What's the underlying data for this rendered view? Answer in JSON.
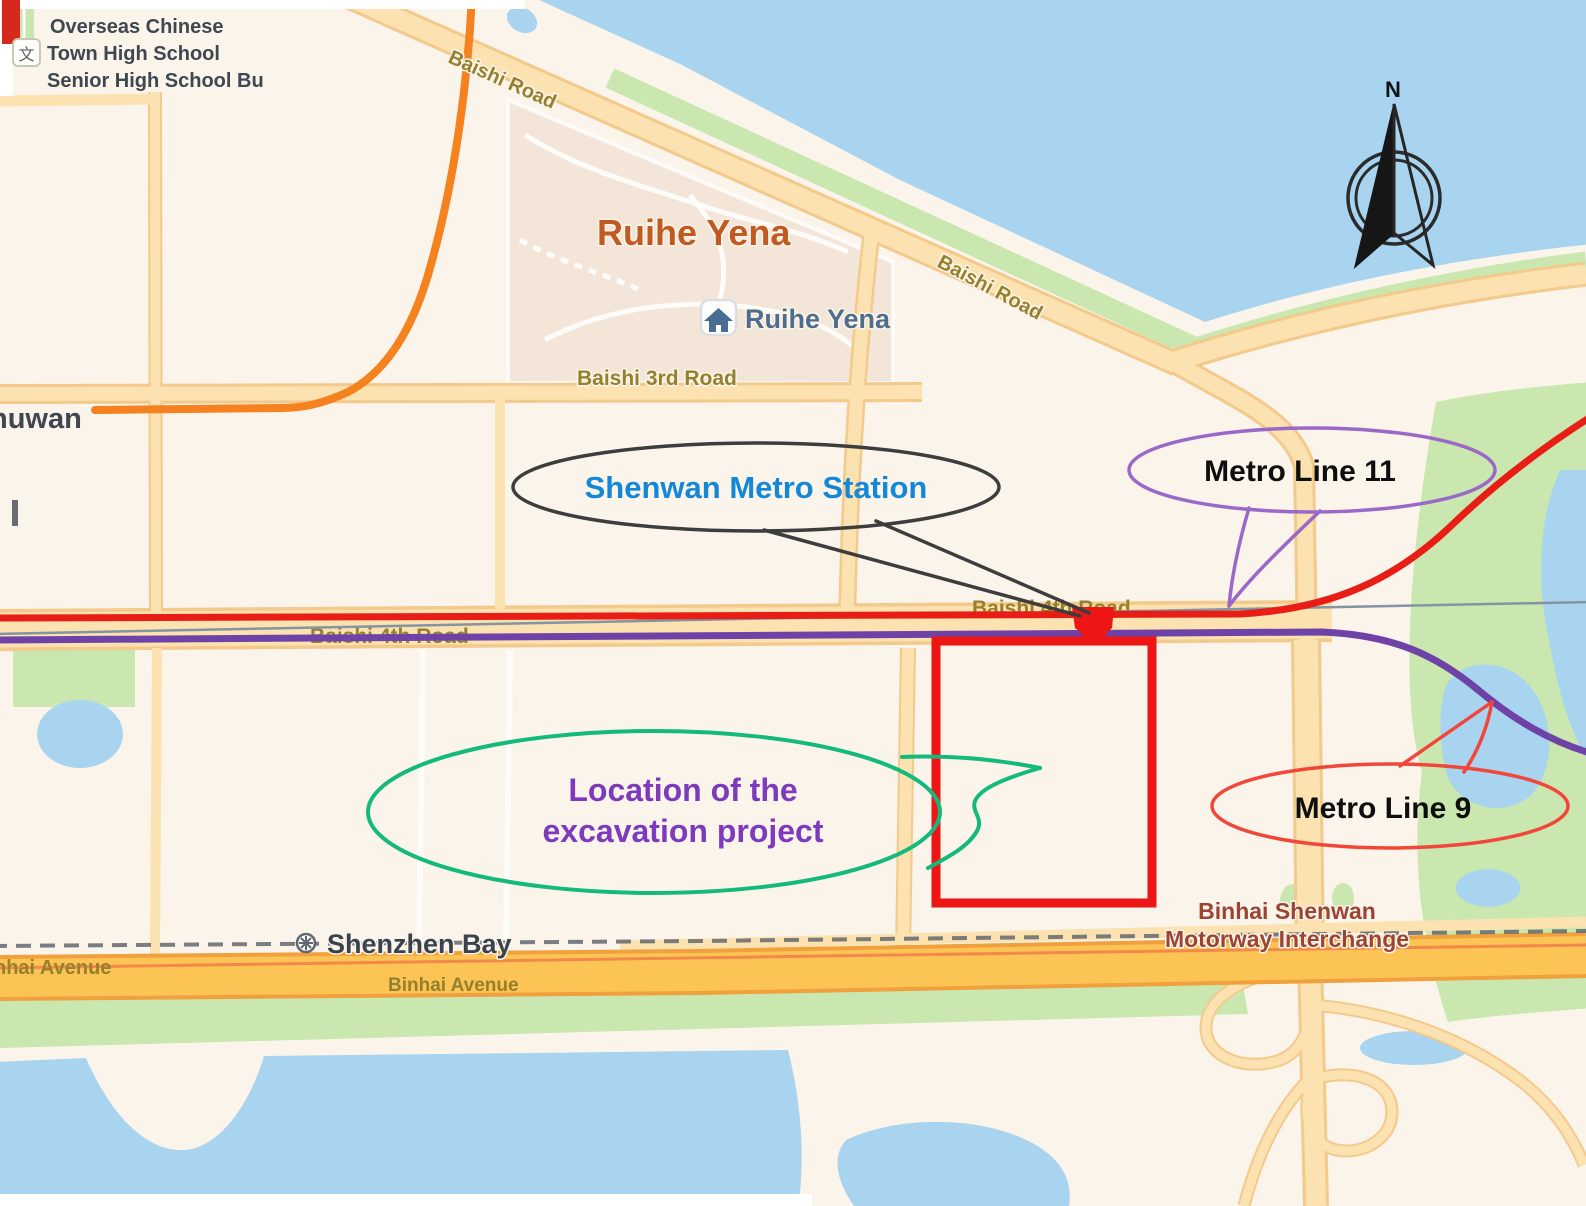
{
  "map": {
    "region_labels": {
      "school_line1": "Overseas Chinese",
      "school_line2": "Town High School",
      "school_line3": "Senior High School Bu",
      "district_partial": "nuwan",
      "residential_area": "Ruihe Yena",
      "residential_poi": "Ruihe Yena",
      "bay": "Shenzhen Bay",
      "interchange_line1": "Binhai Shenwan",
      "interchange_line2": "Motorway Interchange"
    },
    "road_labels": {
      "baishi_road": "Baishi Road",
      "baishi_3rd_road": "Baishi 3rd Road",
      "baishi_4th_road": "Baishi 4th Road",
      "binhai_avenue": "Binhai Avenue"
    },
    "callouts": {
      "station": "Shenwan Metro Station",
      "metro_line_11": "Metro Line 11",
      "metro_line_9": "Metro Line 9",
      "excavation_line1": "Location of the",
      "excavation_line2": "excavation project"
    },
    "poi_icons": {
      "school_glyph": "文"
    },
    "compass": {
      "north": "N"
    },
    "colors": {
      "water": "#a9d4ef",
      "park": "#c9e7ae",
      "land": "#fbf4ea",
      "road_fill": "#fbe2b0",
      "road_casing": "#f3c98c",
      "residential": "#f3e6d8",
      "motorway_yellow": "#fcc455",
      "motorway_casing": "#f0a03c",
      "motorway_stripe": "#f2824a",
      "major_orange_road": "#f5821f",
      "railway_gray": "#8494a2",
      "boundary_dash_gray": "#64686d",
      "metro_line_red": "#e81d15",
      "metro_line_purple": "#6f42a8",
      "excavation_box_red": "#ee1515",
      "station_callout_stroke": "#3d3d3d",
      "station_text": "#1487d8",
      "line11_callout_stroke": "#9a68c8",
      "line9_callout_stroke": "#f2463a",
      "excavation_callout_stroke": "#14b97c",
      "excavation_text": "#7d3abd",
      "callout_text_black": "#0e0e0e",
      "map_label_olive": "#95812c",
      "map_label_dark": "#3f4750",
      "bay_label_dark": "#3a434d",
      "interchange_label": "#9c4434",
      "poi_label_blue": "#4f6d8c",
      "residential_label_orange": "#c05a22"
    }
  }
}
